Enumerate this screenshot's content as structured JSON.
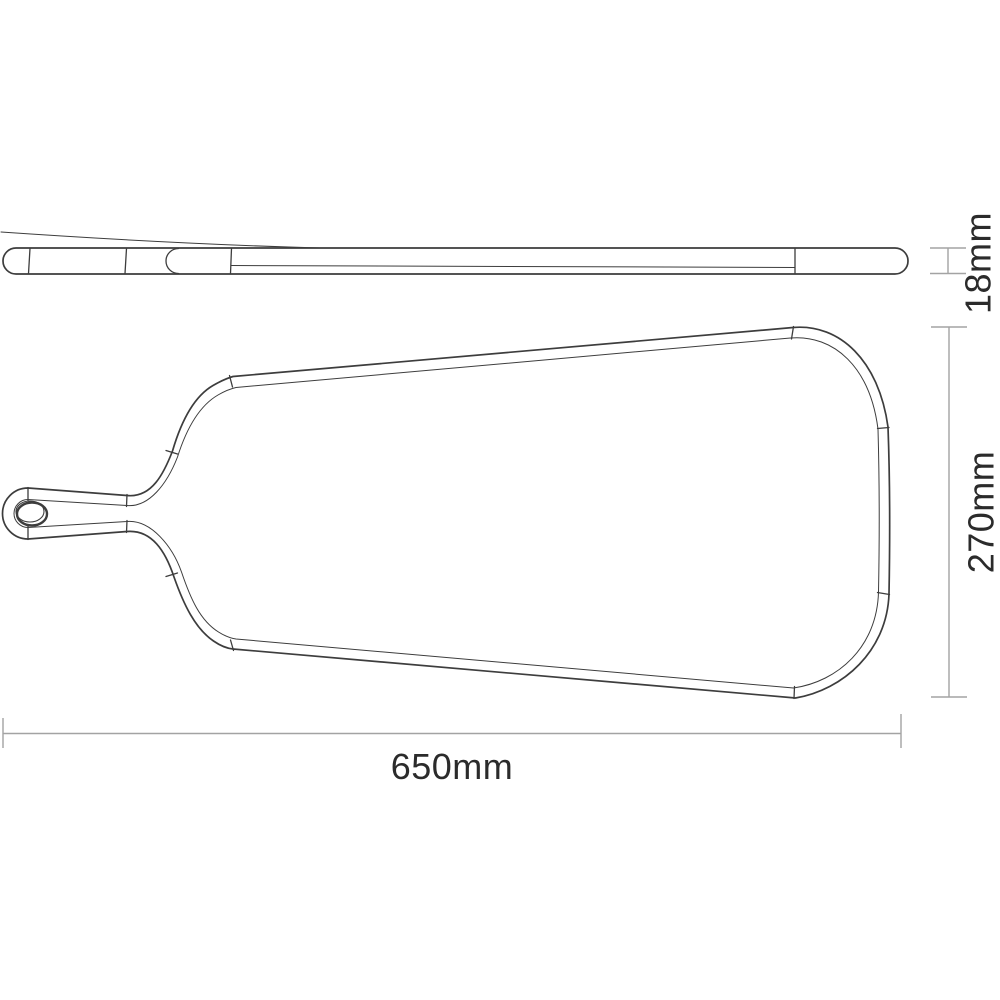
{
  "drawing": {
    "kind": "technical-drawing",
    "views": {
      "side_view": {
        "dimension": {
          "label": "18mm",
          "axis": "thickness"
        }
      },
      "top_view": {
        "dimension_width": {
          "label": "650mm",
          "axis": "horizontal"
        },
        "dimension_height": {
          "label": "270mm",
          "axis": "vertical"
        }
      }
    },
    "colors": {
      "line": "#3d3d3d",
      "dimension_line": "#a3a3a3",
      "text": "#2b2b2b",
      "background": "#ffffff"
    }
  }
}
